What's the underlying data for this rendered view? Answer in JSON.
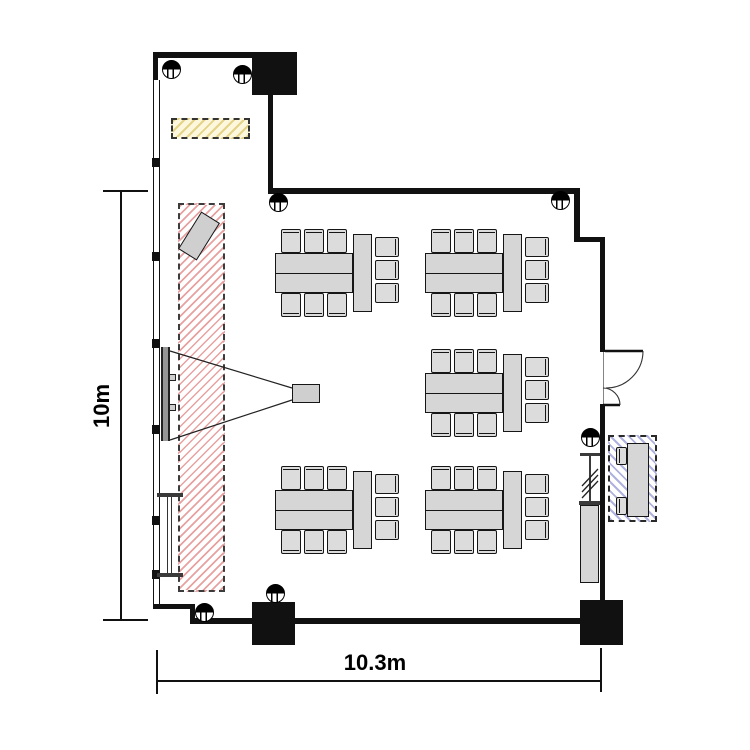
{
  "labels": {
    "width_dim": "10.3m",
    "height_dim": "10m"
  },
  "colors": {
    "wall": "#111111",
    "furniture_fill": "#d6d6d6",
    "chair_fill": "#dcdcdc",
    "stage_hatch": "#d65454",
    "storage_hatch": "#7a7ec8",
    "equipment_hatch": "#e0cd78",
    "screen": "#969696"
  },
  "icons": {
    "datum_marker": "half-filled-circle",
    "door": "double-swing-door-arc",
    "projector": "projector-box",
    "screen": "wall-mounted-screen",
    "partition": "hatched-partition-symbol"
  },
  "plan": {
    "room": {
      "width_m": 10.3,
      "height_m": 10.0
    },
    "seats_per_group": 9,
    "table_groups": [
      {
        "x": 275,
        "y": 229
      },
      {
        "x": 425,
        "y": 229
      },
      {
        "x": 425,
        "y": 349
      },
      {
        "x": 275,
        "y": 466
      },
      {
        "x": 425,
        "y": 466
      }
    ],
    "datum_markers": [
      {
        "x": 171,
        "y": 69
      },
      {
        "x": 242,
        "y": 74
      },
      {
        "x": 560,
        "y": 200
      },
      {
        "x": 278,
        "y": 202
      },
      {
        "x": 204,
        "y": 612
      },
      {
        "x": 275,
        "y": 593
      },
      {
        "x": 590,
        "y": 437
      }
    ]
  }
}
